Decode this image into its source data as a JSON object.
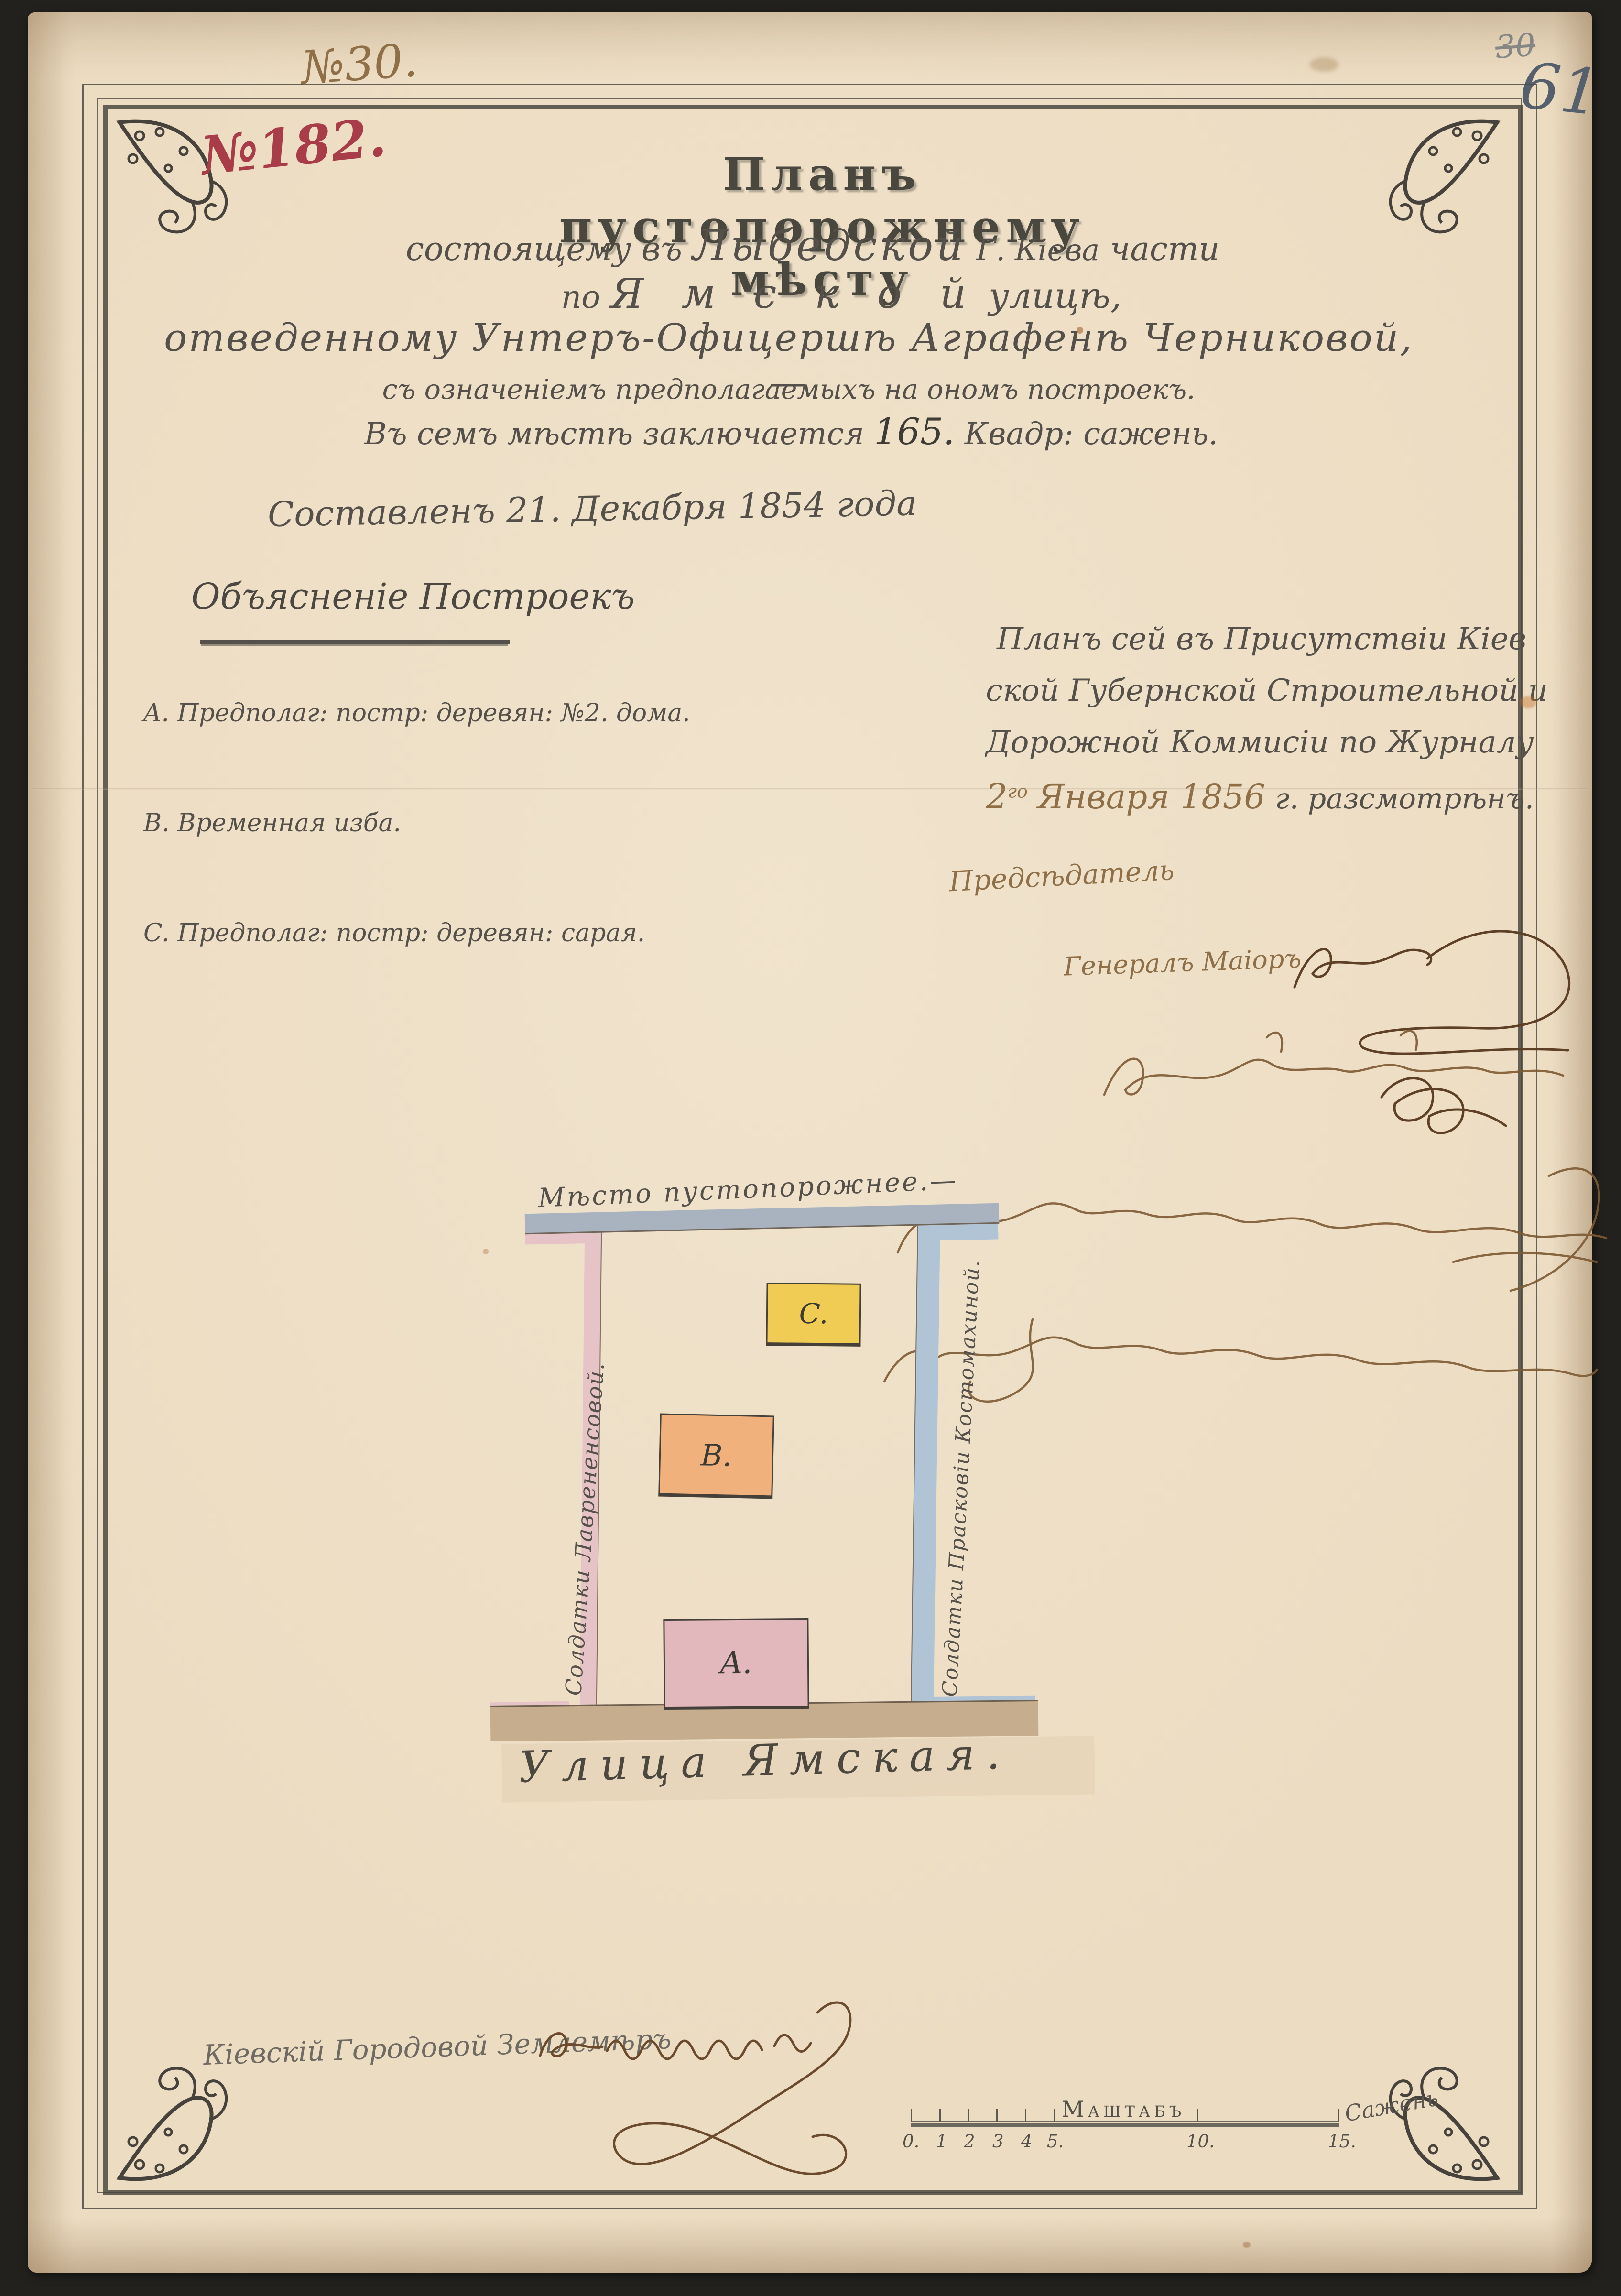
{
  "document": {
    "archive_no_top": "№30.",
    "archive_no_red": "№182.",
    "page_no_pencil": "61",
    "page_no_pencil_crossed": "30",
    "title": "Планъ пустопорожнему мѣсту",
    "location_line": {
      "prefix": "состоящему въ",
      "district": "Лыбедской",
      "city": "Г. Кіева",
      "suffix": "части"
    },
    "street_line": {
      "prefix": "по",
      "street": "Я м с к о й",
      "suffix": "улицѣ,"
    },
    "grantee_line": "отведенному Унтеръ-Офицершѣ Аграфенѣ Черниковой,—",
    "buildings_line": "съ означеніемъ предполагаемыхъ на ономъ построекъ.",
    "area_line": {
      "prefix": "Въ семъ мѣстѣ заключается",
      "value": "165.",
      "suffix": "Квадр: сажень."
    },
    "composed_line": "Составленъ 21. Декабря 1854 года"
  },
  "legend": {
    "heading": "Объясненіе Построекъ",
    "items": [
      {
        "key": "A.",
        "text": "Предполаг: постр: деревян: №2. дома."
      },
      {
        "key": "B.",
        "text": "Временная изба."
      },
      {
        "key": "C.",
        "text": "Предполаг: постр: деревян: сарая."
      }
    ]
  },
  "approval": {
    "line1": "Планъ сей въ Присутствіи Кіев",
    "line2": "ской Губернской Строительной и",
    "line3": "Дорожной Коммисіи по Журналу",
    "date_day": "2",
    "date_day_suffix": "го",
    "date_month_year": "Января 1856",
    "date_tail": "г. разсмотрѣнъ.",
    "chairman_label": "Предсѣдатель",
    "chairman_rank": "Генералъ Маіоръ",
    "illegible_signature_lines": 3
  },
  "plan": {
    "top_label": "Мѣсто пустопорожнее.—",
    "left_label": "Солдатки Лаврененсовой.",
    "right_label": "Солдатки Прасковіи Костомахиной.",
    "street_label": "Улица Ямская.",
    "building_a": "A.",
    "building_b": "B.",
    "building_c": "C."
  },
  "surveyor": {
    "title_line": "Кіевскій Городовой Землемѣръ"
  },
  "scale_bar": {
    "title": "Маштабъ",
    "unit_label": "Сажень",
    "tick_labels": [
      "0.",
      "1",
      "2",
      "3",
      "4",
      "5.",
      "10.",
      "15."
    ]
  },
  "colors": {
    "paper": "#ecdcc2",
    "ink": "#55514a",
    "red_ink": "#a93c49",
    "brown_ink": "#8f6f47",
    "dark_brown_ink": "#6b4a2d",
    "pencil": "#55606c",
    "band_top": "#a9b2bf",
    "band_left": "#e5c3c7",
    "band_right": "#b0c4d6",
    "band_street": "#c6ad8d",
    "building_a_fill": "#e3b8bc",
    "building_b_fill": "#f0b17c",
    "building_c_fill": "#f0cc55"
  }
}
